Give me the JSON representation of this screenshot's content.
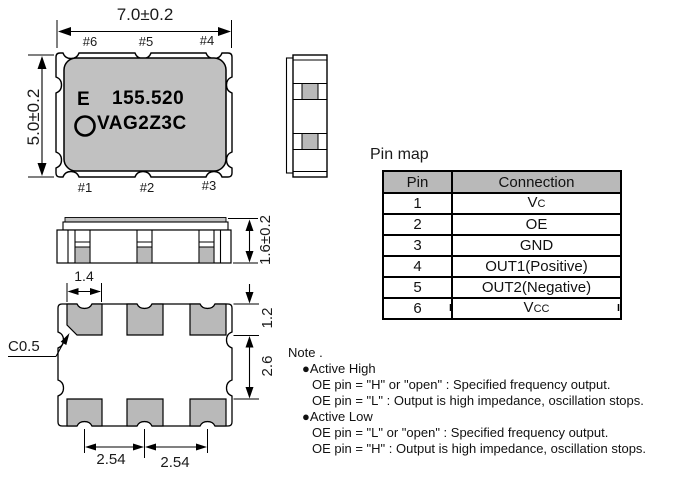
{
  "colors": {
    "package_body_gray": "#c1c1c1",
    "pad_gray": "#b9b9b9",
    "table_header_gray": "#b9b9b9",
    "line_black": "#000000"
  },
  "top_view": {
    "width_dim": "7.0±0.2",
    "height_dim": "5.0±0.2",
    "pins_top": [
      "#6",
      "#5",
      "#4"
    ],
    "pins_bottom": [
      "#1",
      "#2",
      "#3"
    ],
    "marking_letter": "E",
    "marking_frequency": "155.520",
    "marking_code": "VAG2Z3C"
  },
  "front_view": {
    "thickness_dim": "1.6±0.2"
  },
  "bottom_view": {
    "pad_width_dim": "1.4",
    "chamfer_dim": "C0.5",
    "pad_height_dim": "1.2",
    "pad_gap_dim": "2.6",
    "pitch_left_dim": "2.54",
    "pitch_right_dim": "2.54"
  },
  "pin_map": {
    "title": "Pin map",
    "headers": [
      "Pin",
      "Connection"
    ],
    "rows": [
      {
        "pin": "1",
        "connection": "Vc",
        "smallcaps": true
      },
      {
        "pin": "2",
        "connection": "OE",
        "smallcaps": false
      },
      {
        "pin": "3",
        "connection": "GND",
        "smallcaps": false
      },
      {
        "pin": "4",
        "connection": "OUT1(Positive)",
        "smallcaps": false
      },
      {
        "pin": "5",
        "connection": "OUT2(Negative)",
        "smallcaps": false
      },
      {
        "pin": "6",
        "connection": "Vcc",
        "smallcaps": true
      }
    ]
  },
  "note": {
    "title": "Note .",
    "sections": [
      {
        "bullet": "●",
        "label": "Active High",
        "lines": [
          "OE pin = \"H\" or \"open\" : Specified frequency output.",
          "OE pin = \"L\" : Output is high impedance, oscillation stops."
        ]
      },
      {
        "bullet": "●",
        "label": "Active Low",
        "lines": [
          "OE pin = \"L\" or \"open\" : Specified frequency output.",
          "OE pin = \"H\" : Output is high impedance, oscillation stops."
        ]
      }
    ]
  }
}
